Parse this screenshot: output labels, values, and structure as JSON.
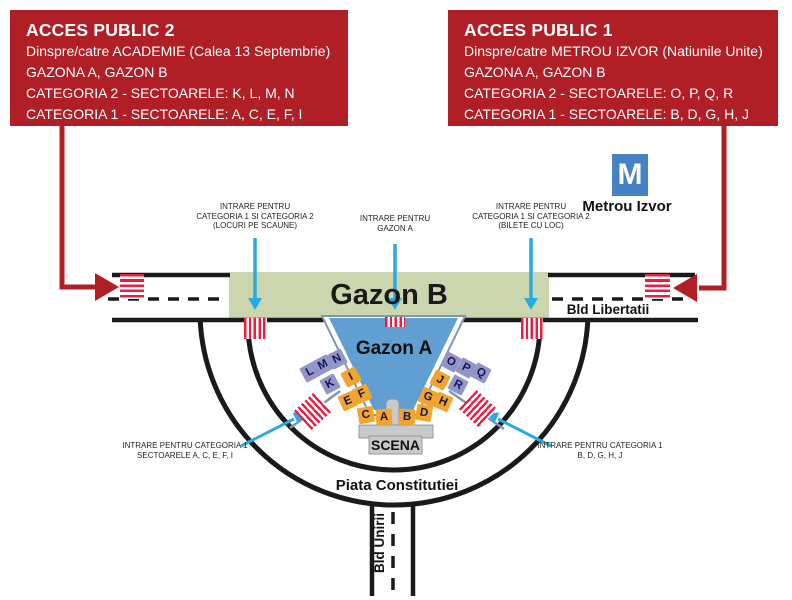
{
  "access_boxes": {
    "left": {
      "title": "ACCES PUBLIC 2",
      "lines": [
        "Dinspre/catre ACADEMIE (Calea 13 Septembrie)",
        "GAZONA A, GAZON B",
        "CATEGORIA 2 - SECTOARELE: K, L, M, N",
        "CATEGORIA 1 - SECTOARELE: A, C, E, F, I"
      ]
    },
    "right": {
      "title": "ACCES PUBLIC 1",
      "lines": [
        "Dinspre/catre METROU IZVOR (Natiunile Unite)",
        "GAZONA A, GAZON B",
        "CATEGORIA 2 - SECTOARELE: O, P, Q, R",
        "CATEGORIA 1 - SECTOARELE: B, D, G, H, J"
      ]
    }
  },
  "metro": {
    "symbol": "M",
    "station_label": "Metrou Izvor"
  },
  "map_labels": {
    "gazon_b": "Gazon B",
    "gazon_a": "Gazon A",
    "stage": "SCENA",
    "boulevard_horizontal": "Bld Libertatii",
    "roundabout": "Piata Constitutiei",
    "boulevard_vertical": "Bld Unirii"
  },
  "entrance_labels": {
    "seated_left": {
      "lines": [
        "INTRARE PENTRU",
        "CATEGORIA 1 SI CATEGORIA 2",
        "(LOCURI PE SCAUNE)"
      ]
    },
    "gazon_a": {
      "lines": [
        "INTRARE PENTRU",
        "GAZON A"
      ]
    },
    "seated_right": {
      "lines": [
        "INTRARE PENTRU",
        "CATEGORIA 1 SI CATEGORIA 2",
        "(BILETE CU LOC)"
      ]
    },
    "category1_left": {
      "lines": [
        "INTRARE PENTRU CATEGORIA 1",
        "SECTOARELE A, C, E, F, I"
      ]
    },
    "category1_right": {
      "lines": [
        "INTRARE PENTRU CATEGORIA 1",
        "B, D, G, H, J"
      ]
    }
  },
  "sectors": {
    "tiles": [
      {
        "letter": "L",
        "category": 2
      },
      {
        "letter": "M",
        "category": 2
      },
      {
        "letter": "N",
        "category": 2
      },
      {
        "letter": "K",
        "category": 2
      },
      {
        "letter": "I",
        "category": 1
      },
      {
        "letter": "F",
        "category": 1
      },
      {
        "letter": "E",
        "category": 1
      },
      {
        "letter": "C",
        "category": 1
      },
      {
        "letter": "A",
        "category": 1
      },
      {
        "letter": "B",
        "category": 1
      },
      {
        "letter": "D",
        "category": 1
      },
      {
        "letter": "G",
        "category": 1
      },
      {
        "letter": "H",
        "category": 1
      },
      {
        "letter": "J",
        "category": 1
      },
      {
        "letter": "R",
        "category": 2
      },
      {
        "letter": "O",
        "category": 2
      },
      {
        "letter": "P",
        "category": 2
      },
      {
        "letter": "Q",
        "category": 2
      }
    ]
  },
  "colors": {
    "box_red": "#b01f26",
    "hatch_red": "#ee1c3f",
    "cyan": "#29abe2",
    "gazon_b_green": "#ccd6ae",
    "gazon_a_blue": "#619fd2",
    "category2_purple": "#9295c8",
    "category1_orange": "#f2a42d",
    "metro_blue": "#4681c3",
    "stage_gray": "#c8c9cb",
    "slate_line": "#8095b5",
    "road_black": "#1a1a1a"
  }
}
